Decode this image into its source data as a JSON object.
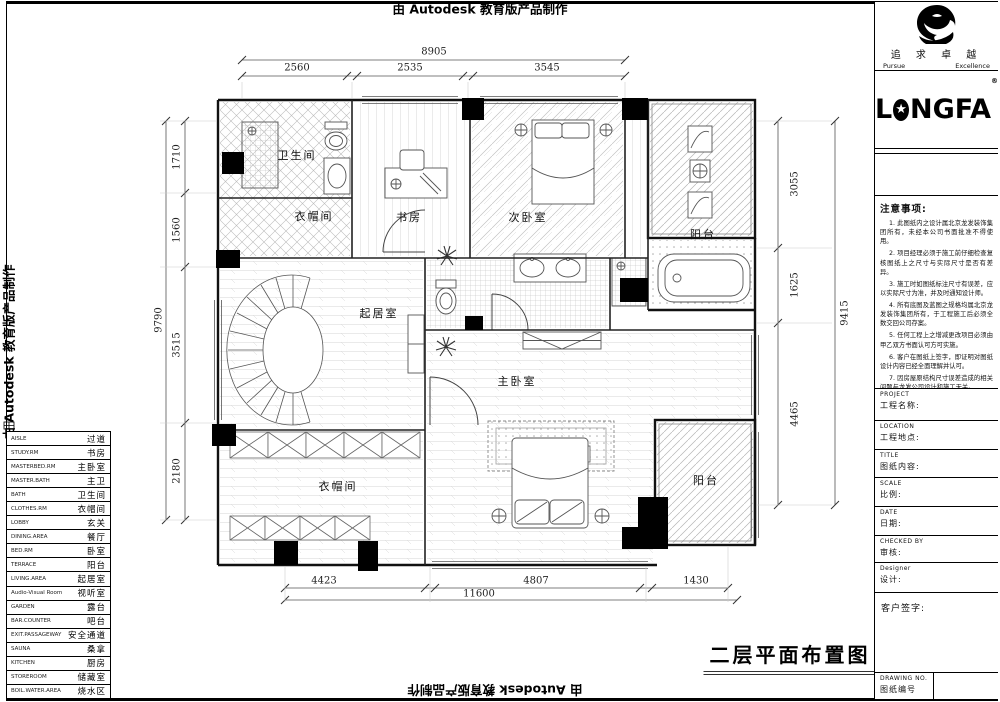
{
  "banner": {
    "text": "由 Autodesk 教育版产品制作"
  },
  "plan": {
    "title": "二层平面布置图",
    "rooms": [
      {
        "label": "卫生间"
      },
      {
        "label": "衣帽间"
      },
      {
        "label": "书房"
      },
      {
        "label": "次卧室"
      },
      {
        "label": "阳台"
      },
      {
        "label": "起居室"
      },
      {
        "label": "主卧室"
      },
      {
        "label": "衣帽间"
      },
      {
        "label": "阳台"
      }
    ],
    "dims": {
      "top": {
        "overall": "8905",
        "segments": [
          "2560",
          "2535",
          "3545"
        ]
      },
      "bottom": {
        "overall": "11600",
        "segments": [
          "4423",
          "4807",
          "1430"
        ]
      },
      "left": {
        "overall": "9790",
        "segments": [
          "1710",
          "1560",
          "3515",
          "2180"
        ]
      },
      "right": {
        "overall": "9415",
        "segments": [
          "3055",
          "1625",
          "4465"
        ]
      }
    }
  },
  "legend": {
    "rows": [
      {
        "en": "AISLE",
        "cn": "过道"
      },
      {
        "en": "STUDY.RM",
        "cn": "书房"
      },
      {
        "en": "MASTERBED.RM",
        "cn": "主卧室"
      },
      {
        "en": "MASTER.BATH",
        "cn": "主卫"
      },
      {
        "en": "BATH",
        "cn": "卫生间"
      },
      {
        "en": "CLOTHES.RM",
        "cn": "衣帽间"
      },
      {
        "en": "LOBBY",
        "cn": "玄关"
      },
      {
        "en": "DINING.AREA",
        "cn": "餐厅"
      },
      {
        "en": "BED.RM",
        "cn": "卧室"
      },
      {
        "en": "TERRACE",
        "cn": "阳台"
      },
      {
        "en": "LIVING.AREA",
        "cn": "起居室"
      },
      {
        "en": "Audio-Visual Room",
        "cn": "视听室"
      },
      {
        "en": "GARDEN",
        "cn": "露台"
      },
      {
        "en": "BAR.COUNTER",
        "cn": "吧台"
      },
      {
        "en": "EXIT.PASSAGEWAY",
        "cn": "安全通道"
      },
      {
        "en": "SAUNA",
        "cn": "桑拿"
      },
      {
        "en": "KITCHEN",
        "cn": "厨房"
      },
      {
        "en": "STOREROOM",
        "cn": "储藏室"
      },
      {
        "en": "BOIL.WATER.AREA",
        "cn": "烧水区"
      }
    ]
  },
  "titleblock": {
    "motto_cn": "追 求 卓 越",
    "motto_en_left": "Pursue",
    "motto_en_right": "Excellence",
    "brand": {
      "l": "L",
      "star": "★",
      "rest": "NGFA",
      "reg": "®"
    },
    "notes_title": "注意事项:",
    "notes": [
      "1. 此图纸内之设计属北京龙发装饰集团所有，未经本公司书面批准不得使用。",
      "2. 项目经理必须于施工前仔细检查复核图纸上之尺寸与实际尺寸是否有差异。",
      "3. 施工时如图纸标注尺寸有误差，应以实际尺寸为准，并及时通知设计师。",
      "4. 所有底图及蓝图之规格均属北京龙发装饰集团所有，于工程施工后必须全数交回公司存案。",
      "5. 任何工程上之增减更改项目必须由甲乙双方书面认可方可实施。",
      "6. 客户在图纸上签字，即证明对图纸设计内容已经全面理解并认可。",
      "7. 因房屋原结构尺寸误差造成的相关问题与龙发公司设计和施工无关。"
    ],
    "fields": [
      {
        "en": "PROJECT",
        "cn": "工程名称:"
      },
      {
        "en": "LOCATION",
        "cn": "工程地点:"
      },
      {
        "en": "TITLE",
        "cn": "图纸内容:"
      },
      {
        "en": "SCALE",
        "cn": "比例:"
      },
      {
        "en": "DATE",
        "cn": "日期:"
      },
      {
        "en": "CHECKED  BY",
        "cn": "审核:"
      },
      {
        "en": "Designer",
        "cn": "设计:"
      }
    ],
    "client_sign": "客户签字:",
    "drawing_no": {
      "en": "DRAWING NO.",
      "cn": "图纸编号"
    }
  }
}
